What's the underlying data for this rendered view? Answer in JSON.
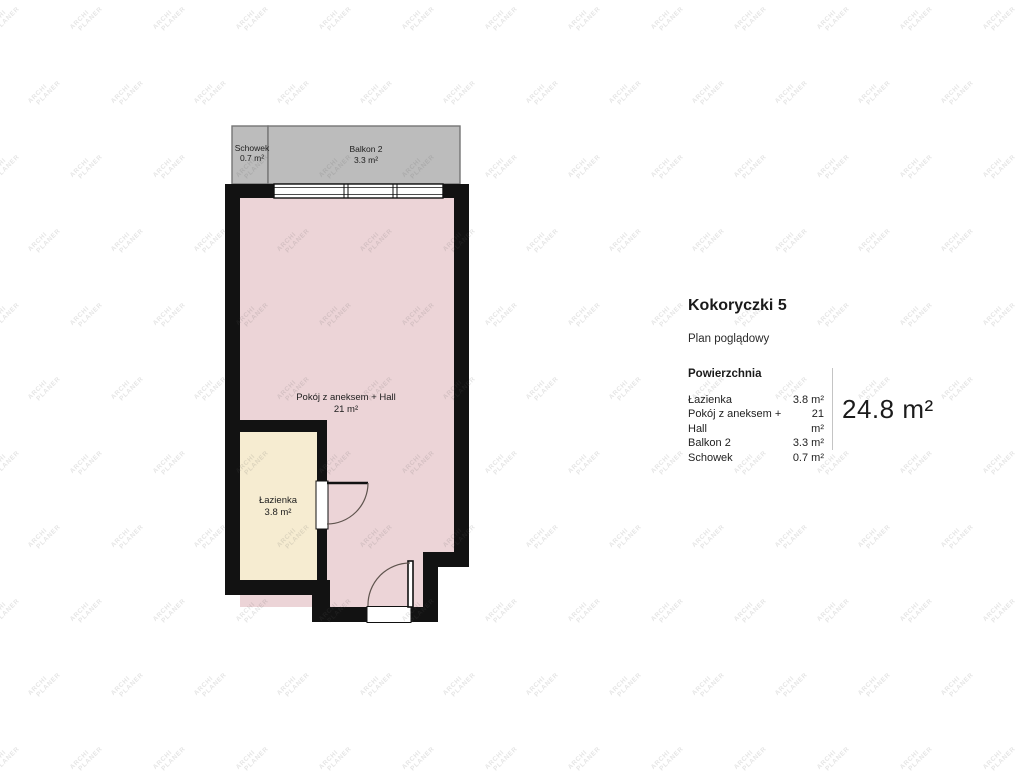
{
  "watermark": {
    "line1": "ARCHI",
    "line2": "PLANER"
  },
  "plan": {
    "schowek": {
      "name": "Schowek",
      "area": "0.7 m²"
    },
    "balkon": {
      "name": "Balkon 2",
      "area": "3.3 m²"
    },
    "main_room": {
      "name": "Pokój z aneksem + Hall",
      "area": "21 m²"
    },
    "bathroom": {
      "name": "Łazienka",
      "area": "3.8 m²"
    }
  },
  "panel": {
    "title": "Kokoryczki 5",
    "subtitle": "Plan poglądowy",
    "section_heading": "Powierzchnia",
    "rows": [
      {
        "label": "Łazienka",
        "value": "3.8 m²"
      },
      {
        "label": "Pokój z aneksem + Hall",
        "value": "21 m²"
      },
      {
        "label": "Balkon 2",
        "value": "3.3 m²"
      },
      {
        "label": "Schowek",
        "value": "0.7 m²"
      }
    ],
    "total": "24.8 m²"
  },
  "colors": {
    "room_pink": "#ecd4d7",
    "bath_cream": "#f6ecd1",
    "balcony_gray": "#bcbcbc",
    "balcony_border": "#757575",
    "wall_black": "#121212",
    "door_arc": "#5f544e"
  }
}
